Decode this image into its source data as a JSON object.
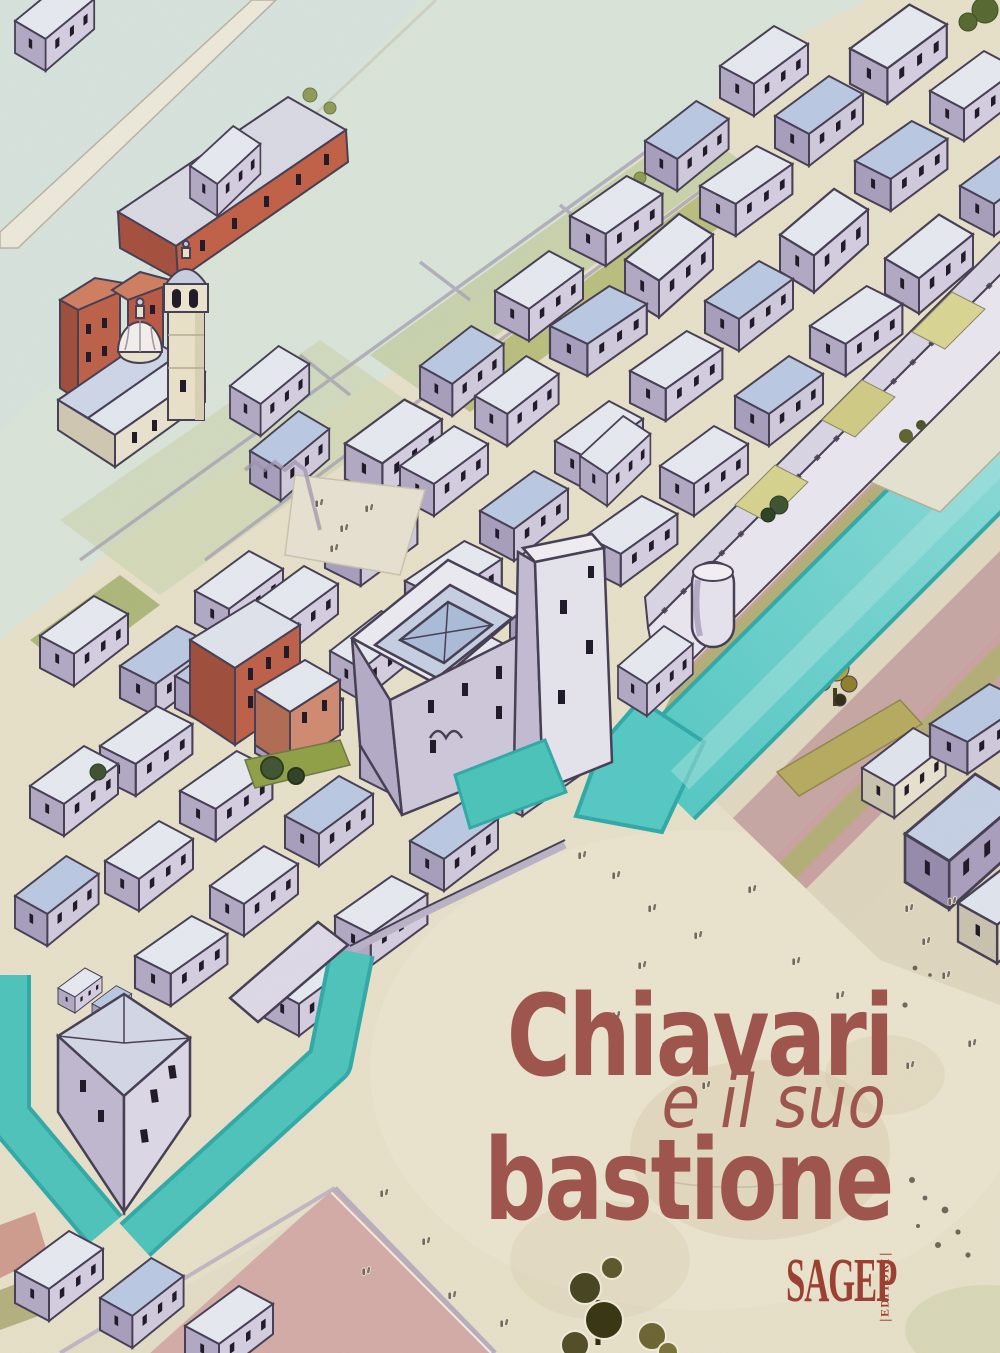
{
  "cover": {
    "title": {
      "line1": "Chiavari",
      "line2": "e il suo",
      "line3": "bastione",
      "color": "#9e554e"
    },
    "publisher": {
      "name": "SAGEP",
      "division": "EDITORI",
      "color": "#9c4033"
    },
    "artwork_colors": {
      "canal_water": "#63cfcb",
      "beach_sand": "#e7e0c9",
      "green_fields": "#d9e4d8",
      "roofs": "#e6e9f1",
      "building_walls": "#d3cde0",
      "red_buildings": "#bd5f47",
      "striped_fields_pink": "#cba4a1",
      "outline_ink": "#443c52"
    }
  }
}
